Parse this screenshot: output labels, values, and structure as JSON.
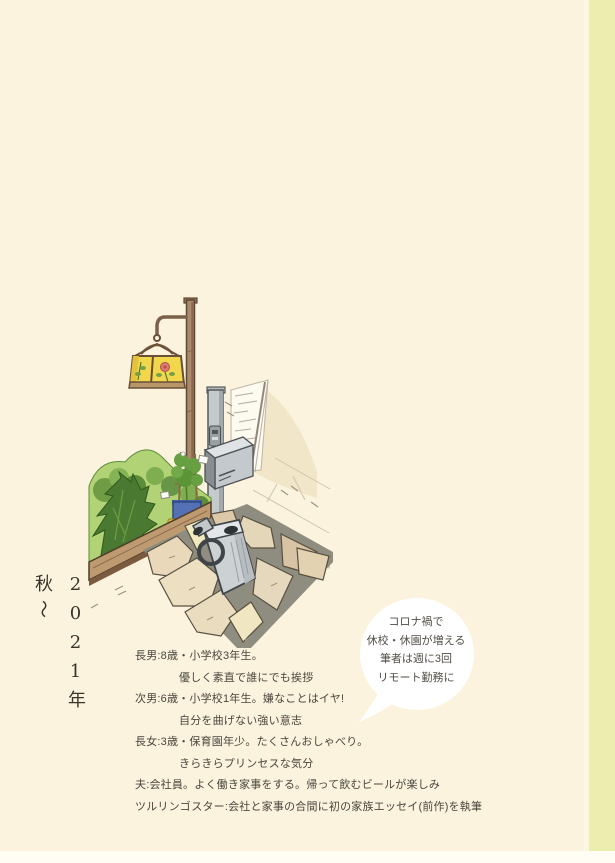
{
  "palette": {
    "page_bg": "#fbf3dd",
    "next_page_edge": "#ecedae",
    "bottom_strip": "#fffdf4",
    "text": "#4a463f",
    "bubble_bg": "#ffffff",
    "lantern_glass": "#f2d74d",
    "garden_green": "#b2d276",
    "conifer_green": "#4a7a31",
    "planter_blue": "#5471b5",
    "toy_car_yellow": "#e8ca3a",
    "wood_plank": "#bd9a70",
    "metal_gray": "#c5cacd",
    "flagstone_tan": "#e4d6b8"
  },
  "vertical_title": {
    "main": "2021年 秋",
    "wave": "〜"
  },
  "speech_bubble": {
    "lines": [
      "コロナ禍で",
      "休校・休園が増える",
      "筆者は週に3回",
      "リモート勤務に"
    ]
  },
  "family_profiles": [
    {
      "text": "長男:8歳・小学校3年生。"
    },
    {
      "text": "優しく素直で誰にでも挨拶"
    },
    {
      "text": "次男:6歳・小学校1年生。嫌なことはイヤ!"
    },
    {
      "text": "自分を曲げない強い意志"
    },
    {
      "text": "長女:3歳・保育園年少。たくさんおしゃべり。"
    },
    {
      "text": "きらきらプリンセスな気分"
    },
    {
      "text": "夫:会社員。よく働き家事をする。帰って飲むビールが楽しみ"
    },
    {
      "text": "ツルリンゴスター:会社と家事の合間に初の家族エッセイ(前作)を執筆"
    }
  ],
  "illustration_elements": [
    "garden-lamp-post",
    "stained-glass-lantern",
    "white-wall-sketch",
    "intercom-post",
    "mailbox",
    "garden-bed",
    "conifer-shrub",
    "tomato-planter",
    "plant-tags",
    "toy-car",
    "wood-edge-plank",
    "watering-can",
    "flagstone-path",
    "stone-step"
  ]
}
